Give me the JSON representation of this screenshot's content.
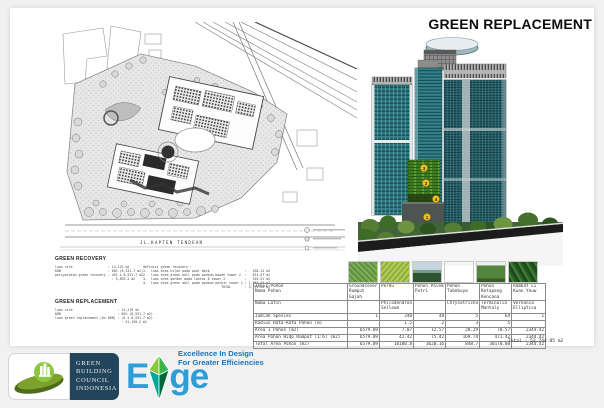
{
  "slide": {
    "title": "GREEN REPLACEMENT",
    "site_plan": {
      "street_label": "JL.KAPTEN TENDEAN"
    },
    "green_recovery": {
      "heading": "GREEN RECOVERY",
      "lines_left": [
        "luas site                  : 14,219 m2",
        "KDB                        : 60% (8,531.7 m2)",
        "persyaratan green recovery : 45% x 8,531.7 m2",
        "                             : 3,839.2 m2"
      ],
      "lines_right": [
        "definisi green recovery :",
        "1.  luas area hijau pada pool deck                  :   438.12 m2",
        "2.  luas area green wall pada podium bawah tower 2  :   874.67 m2",
        "3.  luas area garden pada lantai 8 tower 2          :   510.51 m2",
        "4.  luas area green wall pada podium parkir tower 1 : 1,983.04 m2",
        "",
        "                                        TOTAL       : 3,791.84 m2"
      ]
    },
    "green_replacement": {
      "heading": "GREEN REPLACEMENT",
      "lines": [
        "luas site                       : 14,219 m2",
        "KDB                             : 60% (8,531.7 m2)",
        "luas green replacement (6x KDB) : (6 x 8,531.7 m2)",
        "                                  : 51,190.2 m2"
      ]
    },
    "building": {
      "markers": [
        "3",
        "2",
        "4",
        "1"
      ]
    },
    "table": {
      "row_defs": [
        {
          "key": "name",
          "label": "Jenis Pohon\nNama Pohon"
        },
        {
          "key": "latin",
          "label": "Nama Latin"
        },
        {
          "key": "jumlah",
          "label": "Jumlah Spesies"
        },
        {
          "key": "radius",
          "label": "Radius Rata-Rata Pohon (m)"
        },
        {
          "key": "area1",
          "label": "Area 1 Pohon (m2)"
        },
        {
          "key": "area_hidup",
          "label": "Area Pohon Hidp Rumput (1:6) (m2)"
        },
        {
          "key": "total",
          "label": "Total Area Pohon (m2)"
        }
      ],
      "cols": [
        {
          "photo": "groundcover-photo",
          "name": "Groundcover Rumput Gajah",
          "latin": "",
          "jumlah": "1",
          "radius": "",
          "area1": "6579.09",
          "area_hidup": "6579.09",
          "total": "6579.09"
        },
        {
          "photo": "perdu-photo",
          "name": "Perdu",
          "latin": "Philodendron Selloum",
          "jumlah": "240",
          "radius": "1.5",
          "area1": "7.07",
          "area_hidup": "42.42",
          "total": "10180.8"
        },
        {
          "photo": "palem-putri-photo",
          "name": "Pohon Palem Putri",
          "latin": "",
          "jumlah": "48",
          "radius": "2",
          "area1": "12.57",
          "area_hidup": "75.42",
          "total": "3620.16"
        },
        {
          "photo": "tabebuya-photo",
          "name": "Pohon Tabebuya",
          "latin": "Chrysotricha",
          "jumlah": "5",
          "radius": "3",
          "area1": "28.29",
          "area_hidup": "169.74",
          "total": "848.7"
        },
        {
          "photo": "ketapang-kencana-photo",
          "name": "Pohon Ketapang Kencana",
          "latin": "Terminalia Mantaly",
          "jumlah": "64",
          "radius": "5",
          "area1": "78.57",
          "area_hidup": "471.42",
          "total": "30170.88"
        },
        {
          "photo": "li-kuan-yeuw-photo",
          "name": "Rambat Li Kuan Yeuw",
          "latin": "Vernonia Elliptica",
          "jumlah": "1",
          "radius": "",
          "area1": "2344.42",
          "area_hidup": "2344.42",
          "total": "2344.42"
        }
      ],
      "total_label": "Total : 53,744.05  m2"
    },
    "logos": {
      "gbci": {
        "lines": [
          "GREEN",
          "BUILDING",
          "COUNCIL",
          "INDONESIA"
        ]
      },
      "edge": {
        "wordmark_left": "E",
        "wordmark_right": "ge",
        "tagline_line1": "Excellence In Design",
        "tagline_line2": "For Greater Efficiencies"
      }
    },
    "colors": {
      "marker_yellow": "#f0c419",
      "tower_teal": "#2a7680",
      "green_wall": "#3f7d22",
      "edge_blue": "#2d9fd6",
      "tagline_blue": "#1b75bc",
      "gbci_navy": "#23455c",
      "gbci_leaf_green": "#8dc63f",
      "background_gray": "#f1f1f1"
    }
  }
}
